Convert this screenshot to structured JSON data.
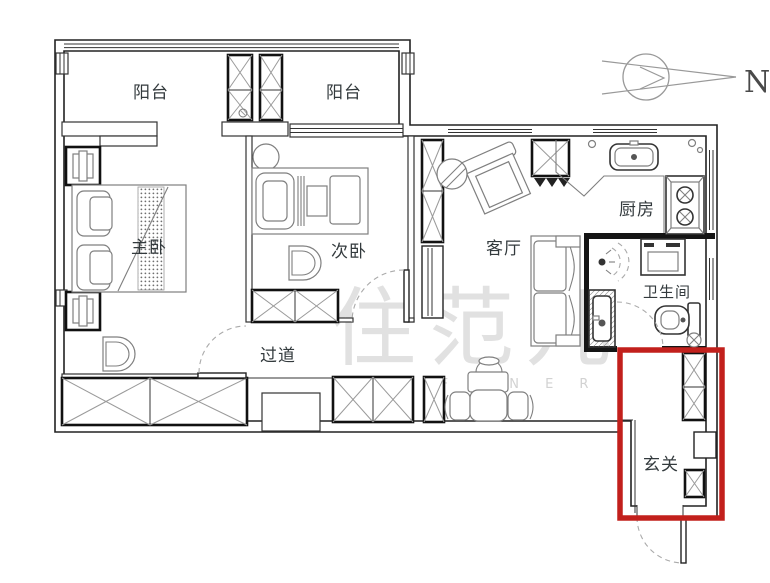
{
  "plan": {
    "watermark": {
      "text": "住范儿",
      "letters": "Z H U F A N E R"
    },
    "compass": {
      "label": "N"
    },
    "rooms": [
      {
        "id": "balcony-left",
        "label": "阳台"
      },
      {
        "id": "balcony-right",
        "label": "阳台"
      },
      {
        "id": "master-bedroom",
        "label": "主卧"
      },
      {
        "id": "second-bedroom",
        "label": "次卧"
      },
      {
        "id": "living-room",
        "label": "客厅"
      },
      {
        "id": "kitchen",
        "label": "厨房"
      },
      {
        "id": "bathroom",
        "label": "卫生间"
      },
      {
        "id": "hallway",
        "label": "过道"
      },
      {
        "id": "entryway",
        "label": "玄关"
      }
    ],
    "highlight": {
      "room": "玄关",
      "color": "#c2201c"
    }
  }
}
